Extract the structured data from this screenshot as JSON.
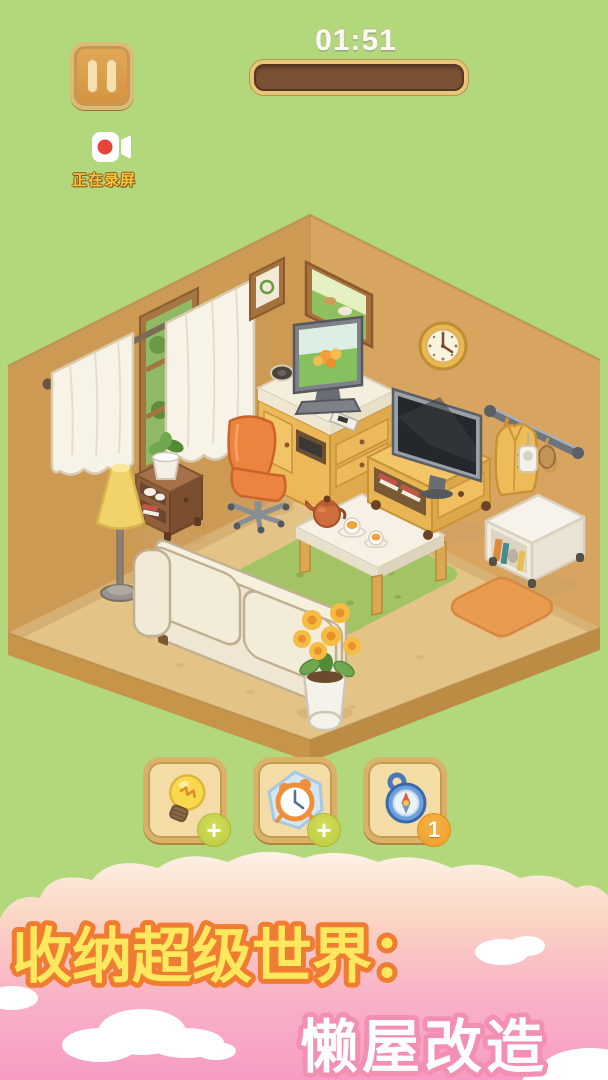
{
  "hud": {
    "timer": "01:51",
    "progress_percent": 0,
    "recording_label": "正在录屏"
  },
  "item_buttons": [
    {
      "name": "hint-bulb",
      "icon": "lightbulb-icon",
      "badge": "+"
    },
    {
      "name": "freeze-time",
      "icon": "alarm-clock-icon",
      "badge": "+"
    },
    {
      "name": "find-item-compass",
      "icon": "compass-icon",
      "badge": "1"
    }
  ],
  "banner": {
    "line1": "收纳超级世界：",
    "line2": "懒屋改造"
  },
  "colors": {
    "background_green": "#b2d87b",
    "wall": "#d4a057",
    "floor": "#e4c386",
    "wood_button": "#f3dca6",
    "badge_green": "#bcc93c",
    "badge_orange": "#ef9c25",
    "record_text": "#f7c43c",
    "banner_pink": "#f79cc5",
    "banner_text_yellow": "#ffe85e",
    "banner_outline_orange": "#ef7c30",
    "banner_text2_outline": "#f48fb4"
  },
  "scene": {
    "furniture": [
      "window-curtains",
      "picture-frame",
      "landscape-painting",
      "wall-clock",
      "tv-cabinet",
      "desktop-monitor",
      "office-chair",
      "side-table",
      "potted-plant",
      "floor-lamp",
      "sofa",
      "flower-pot",
      "green-rug",
      "coffee-table",
      "teapot",
      "tea-cups",
      "tv-stand",
      "television",
      "coat-rack",
      "hanging-jacket",
      "white-bookshelf",
      "orange-rug"
    ]
  }
}
